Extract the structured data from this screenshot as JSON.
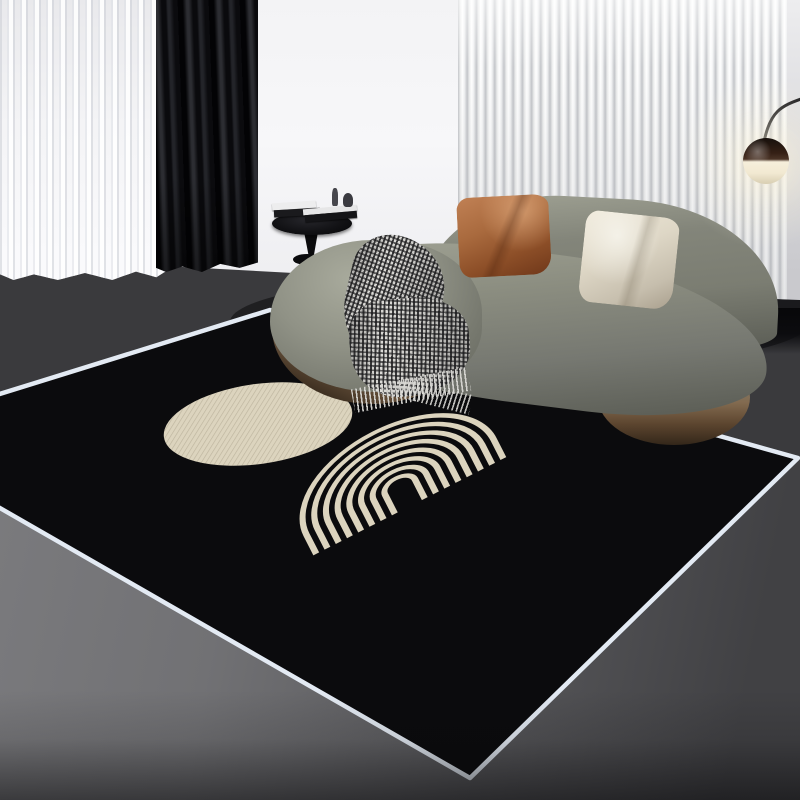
{
  "scene": {
    "kind": "natural-image",
    "description": "Product photo of a modern living room: black area rug with light-blue bound edges and cream geometric motifs (a circle and a striped arch), a curved olive-green sofa with an orange leather pillow and a cream pillow, a houndstooth throw blanket, a black pedestal side table with books and figurines, white sheer and black curtains on the left, a white vertical-slat wall panel on the right, a globe floor lamp, and a gray floor."
  },
  "colors": {
    "wall": "#f3f3f5",
    "wall_b": "#ececef",
    "slat_hi": "#ffffff",
    "slat_sh": "#c3c5c9",
    "rwall_a": "#ededef",
    "rwall_b": "#c9c9cd",
    "floor_a": "#7e7e81",
    "floor_b": "#565659",
    "floor_c": "#414144",
    "strip": "#3a3a3d",
    "rug": "#0b0b0d",
    "binding": "#e3eaf3",
    "cream": "#dcd4be",
    "sofa_hi": "#a0a294",
    "sofa_mid": "#7b7d72",
    "sofa_dk": "#5d5f57",
    "wood": "#836b50",
    "wood_dk": "#33271a",
    "po_a": "#c08054",
    "po_b": "#70381a",
    "pc_a": "#efe9da",
    "pc_b": "#a99f8d",
    "blk_base": "#dcdbd7",
    "blk_check": "#1c1c1e",
    "cur_bk": "#0b0b0e",
    "cur_fold": "#2c2d32",
    "sheer_a": "#fbfbfd",
    "sheer_b": "#e9e9ec",
    "tbl": "#121215",
    "lamp_top": "#341f14",
    "lamp_glow": "#f6efdb",
    "cable": "#17171a",
    "console": "#1a1a1d"
  },
  "objects": {
    "rug": {
      "shape": "rotated square, perspective view",
      "motifs": [
        "cream-circle",
        "cream-striped-arch"
      ],
      "stripes_in_arch": 8
    },
    "sofa": {
      "style": "curved chaise",
      "pillows": [
        "orange-leather",
        "cream-fabric"
      ],
      "throw": "houndstooth-check"
    },
    "side_table": {
      "items": [
        "white-book-stack",
        "black-book",
        "figurine",
        "figurine"
      ]
    },
    "lamp": {
      "type": "globe arc lamp",
      "state": "on"
    },
    "curtains": [
      "white-sheer",
      "black-blackout"
    ],
    "wall_panel": "white-vertical-slats",
    "console": "black-floating-shelf"
  }
}
